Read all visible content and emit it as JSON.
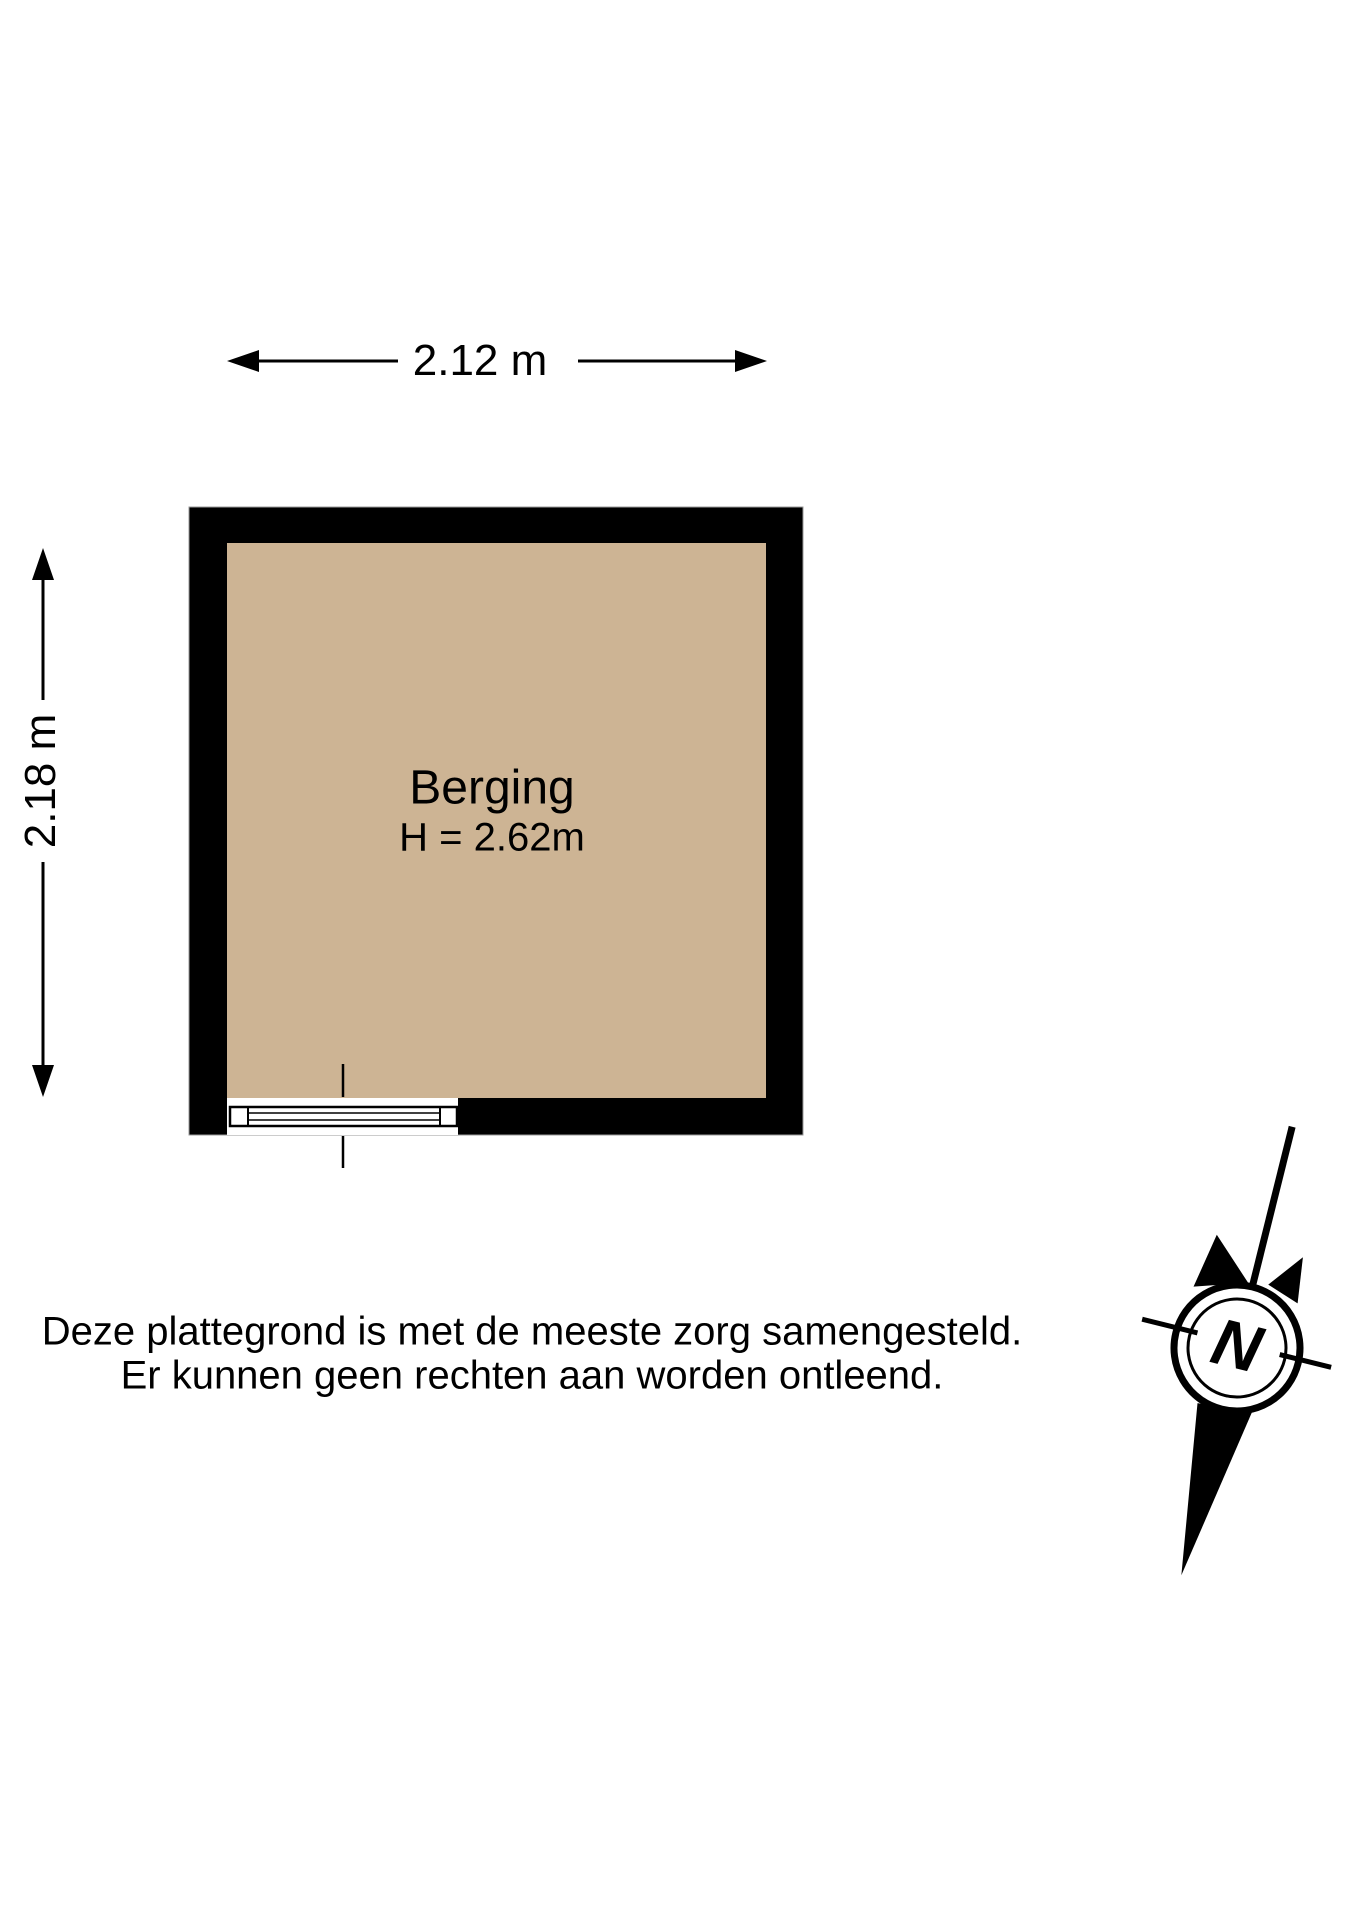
{
  "colors": {
    "background": "#ffffff",
    "wall": "#000000",
    "floor": "#cdb494",
    "line": "#000000",
    "wall_outline": "#9a9a9a"
  },
  "floor_plan": {
    "room": {
      "name": "Berging",
      "ceiling_height": "H = 2.62m"
    },
    "dimensions": {
      "width": "2.12 m",
      "height": "2.18 m"
    }
  },
  "compass": {
    "north": "N"
  },
  "disclaimer": {
    "line1": "Deze plattegrond is met de meeste zorg samengesteld.",
    "line2": "Er kunnen geen rechten aan worden ontleend."
  }
}
